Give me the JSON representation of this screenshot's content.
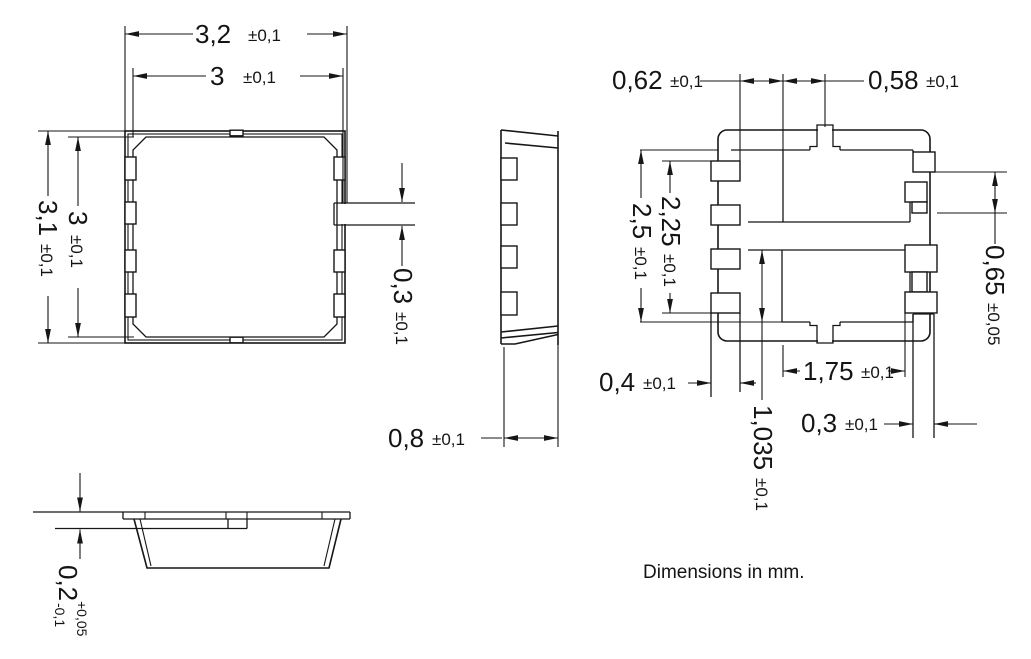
{
  "caption": "Dimensions in mm.",
  "dims": {
    "top_width_outer": {
      "value": "3,2",
      "tol": "±0,1"
    },
    "top_width_lid": {
      "value": "3",
      "tol": "±0,1"
    },
    "top_height_outer": {
      "value": "3,1",
      "tol": "±0,1"
    },
    "top_height_lid": {
      "value": "3",
      "tol": "±0,1"
    },
    "top_tab": {
      "value": "0,3",
      "tol": "±0,1"
    },
    "side_thickness": {
      "value": "0,8",
      "tol": "±0,1"
    },
    "front_step": {
      "value": "0,2",
      "tol_plus": "+0,05",
      "tol_minus": "-0,1"
    },
    "bot_gap_left": {
      "value": "0,62",
      "tol": "±0,1"
    },
    "bot_gap_right": {
      "value": "0,58",
      "tol": "±0,1"
    },
    "bot_span_outer": {
      "value": "2,5",
      "tol": "±0,1"
    },
    "bot_span_inner": {
      "value": "2,25",
      "tol": "±0,1"
    },
    "bot_pad_right": {
      "value": "0,65",
      "tol": "±0,05"
    },
    "bot_pad_width": {
      "value": "0,4",
      "tol": "±0,1"
    },
    "bot_center_width": {
      "value": "1,75",
      "tol": "±0,1"
    },
    "bot_center_height": {
      "value": "1,035",
      "tol": "±0,1"
    },
    "bot_leg_width": {
      "value": "0,3",
      "tol": "±0,1"
    }
  }
}
